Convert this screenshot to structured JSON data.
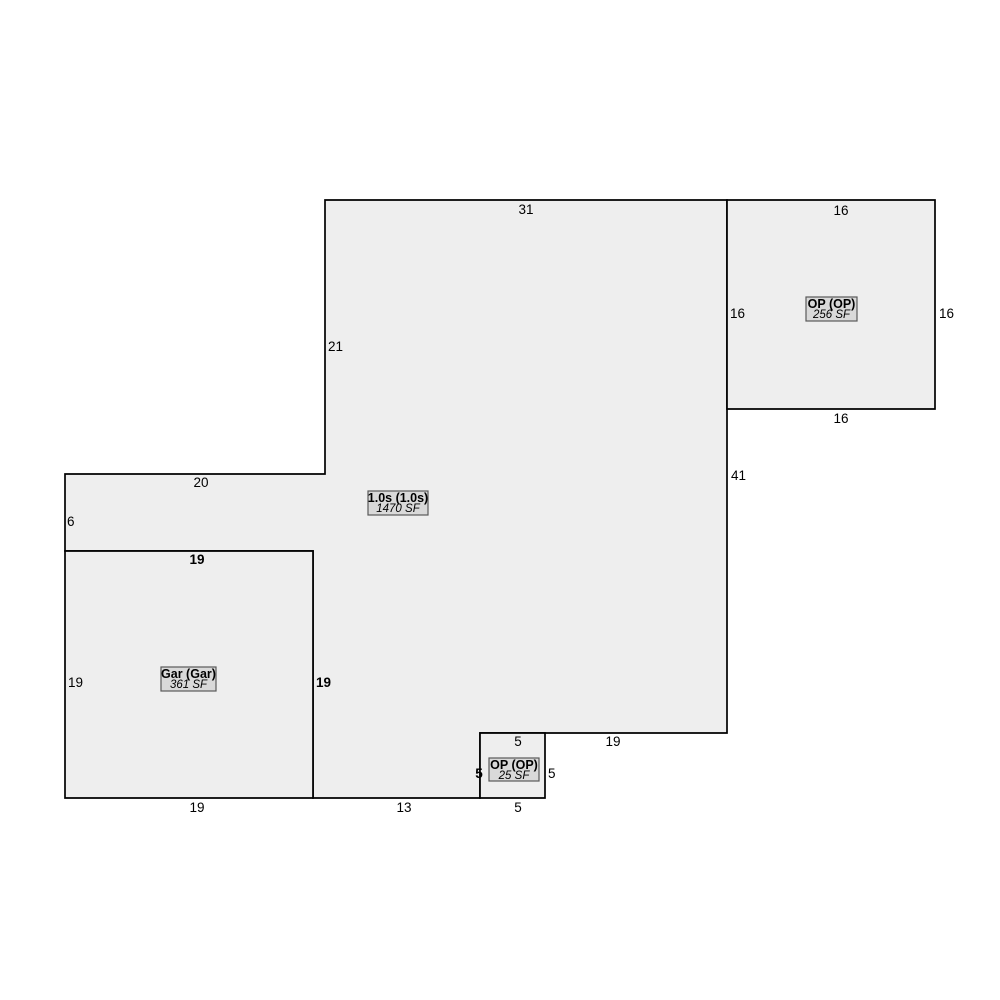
{
  "canvas": {
    "width": 1000,
    "height": 1000,
    "background": "#ffffff"
  },
  "style": {
    "region_fill": "#eeeeee",
    "region_stroke": "#000000",
    "region_stroke_width": 1.7,
    "label_box_fill": "#d9d9d9",
    "label_box_stroke": "#5a5a5a",
    "label_box_stroke_width": 1.2,
    "text_color": "#000000"
  },
  "sketch": {
    "type": "floor-plan",
    "units": "feet",
    "scale_px_per_ft": 13,
    "regions": [
      {
        "id": "main-living-area",
        "title": "1.0s (1.0s)",
        "area": "1470 SF",
        "points": [
          [
            325,
            200
          ],
          [
            727,
            200
          ],
          [
            727,
            733
          ],
          [
            480,
            733
          ],
          [
            480,
            798
          ],
          [
            313,
            798
          ],
          [
            313,
            551
          ],
          [
            65,
            551
          ],
          [
            65,
            474
          ],
          [
            325,
            474
          ]
        ],
        "label_box": {
          "x": 368,
          "y": 491,
          "w": 60,
          "h": 24
        }
      },
      {
        "id": "garage",
        "title": "Gar (Gar)",
        "area": "361 SF",
        "points": [
          [
            65,
            551
          ],
          [
            313,
            551
          ],
          [
            313,
            798
          ],
          [
            65,
            798
          ]
        ],
        "label_box": {
          "x": 161,
          "y": 667,
          "w": 55,
          "h": 24
        }
      },
      {
        "id": "open-porch-large",
        "title": "OP (OP)",
        "area": "256 SF",
        "points": [
          [
            727,
            200
          ],
          [
            935,
            200
          ],
          [
            935,
            409
          ],
          [
            727,
            409
          ]
        ],
        "label_box": {
          "x": 806,
          "y": 297,
          "w": 51,
          "h": 24
        }
      },
      {
        "id": "open-porch-small",
        "title": "OP (OP)",
        "area": "25 SF",
        "points": [
          [
            480,
            733
          ],
          [
            545,
            733
          ],
          [
            545,
            798
          ],
          [
            480,
            798
          ]
        ],
        "label_box": {
          "x": 489,
          "y": 758,
          "w": 50,
          "h": 23
        }
      }
    ],
    "dimension_labels": [
      {
        "text": "31",
        "x": 526,
        "y": 214,
        "anchor": "middle",
        "bold": false,
        "edge": "main-top"
      },
      {
        "text": "21",
        "x": 328,
        "y": 351,
        "anchor": "start",
        "bold": false,
        "edge": "main-upper-left"
      },
      {
        "text": "41",
        "x": 731,
        "y": 480,
        "anchor": "start",
        "bold": false,
        "edge": "main-right"
      },
      {
        "text": "16",
        "x": 841,
        "y": 215,
        "anchor": "middle",
        "bold": false,
        "edge": "porch-large-top"
      },
      {
        "text": "16",
        "x": 730,
        "y": 318,
        "anchor": "start",
        "bold": false,
        "edge": "porch-large-left"
      },
      {
        "text": "16",
        "x": 939,
        "y": 318,
        "anchor": "start",
        "bold": false,
        "edge": "porch-large-right"
      },
      {
        "text": "16",
        "x": 841,
        "y": 423,
        "anchor": "middle",
        "bold": false,
        "edge": "porch-large-bottom"
      },
      {
        "text": "20",
        "x": 201,
        "y": 487,
        "anchor": "middle",
        "bold": false,
        "edge": "main-strip-top"
      },
      {
        "text": "6",
        "x": 67,
        "y": 526,
        "anchor": "start",
        "bold": false,
        "edge": "main-strip-left"
      },
      {
        "text": "19",
        "x": 197,
        "y": 564,
        "anchor": "middle",
        "bold": true,
        "edge": "garage-top"
      },
      {
        "text": "19",
        "x": 68,
        "y": 687,
        "anchor": "start",
        "bold": false,
        "edge": "garage-left"
      },
      {
        "text": "19",
        "x": 316,
        "y": 687,
        "anchor": "start",
        "bold": true,
        "edge": "garage-right"
      },
      {
        "text": "19",
        "x": 197,
        "y": 812,
        "anchor": "middle",
        "bold": false,
        "edge": "garage-bottom"
      },
      {
        "text": "13",
        "x": 404,
        "y": 812,
        "anchor": "middle",
        "bold": false,
        "edge": "main-bottom-middle"
      },
      {
        "text": "19",
        "x": 613,
        "y": 746,
        "anchor": "middle",
        "bold": false,
        "edge": "main-bottom-right"
      },
      {
        "text": "5",
        "x": 518,
        "y": 746,
        "anchor": "middle",
        "bold": false,
        "edge": "porch-small-top"
      },
      {
        "text": "5",
        "x": 479,
        "y": 778,
        "anchor": "middle",
        "bold": true,
        "edge": "porch-small-left"
      },
      {
        "text": "5",
        "x": 548,
        "y": 778,
        "anchor": "start",
        "bold": false,
        "edge": "porch-small-right"
      },
      {
        "text": "5",
        "x": 518,
        "y": 812,
        "anchor": "middle",
        "bold": false,
        "edge": "porch-small-bottom"
      }
    ]
  }
}
